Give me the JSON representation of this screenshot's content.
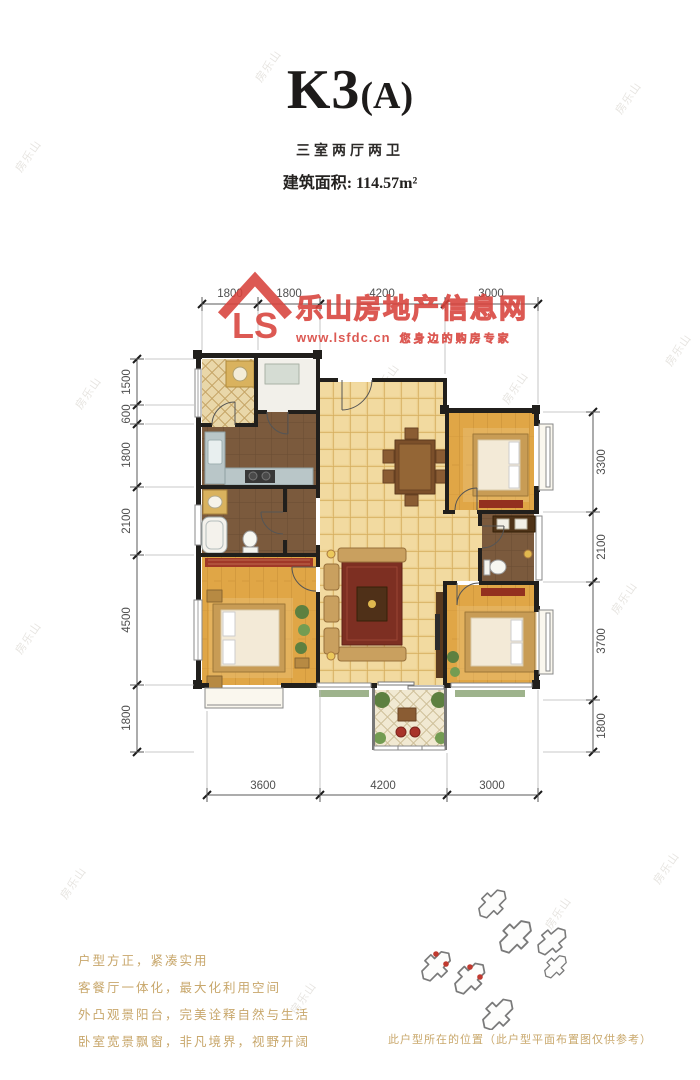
{
  "header": {
    "title_main": "K3",
    "title_paren": "(A)",
    "subtitle": "三室两厅两卫",
    "area": "建筑面积: 114.57m²"
  },
  "brand": {
    "monogram": "LS",
    "site_name": "乐山房地产信息网",
    "site_url": "www.lsfdc.cn",
    "tagline": "您身边的购房专家",
    "color": "#d8433c"
  },
  "watermark": {
    "text": "房乐山"
  },
  "dimensions": {
    "top": [
      "1800",
      "1800",
      "4200",
      "3000"
    ],
    "bottom": [
      "3600",
      "4200",
      "3000"
    ],
    "left": [
      "1500",
      "600",
      "1800",
      "2100",
      "4500",
      "1800"
    ],
    "right": [
      "3300",
      "2100",
      "3700",
      "1800"
    ]
  },
  "selling_points": [
    "户型方正，紧凑实用",
    "客餐厅一体化，最大化利用空间",
    "外凸观景阳台，完美诠释自然与生活",
    "卧室宽景飘窗，非凡境界，视野开阔"
  ],
  "site_plan": {
    "caption": "此户型所在的位置（此户型平面布置图仅供参考）"
  },
  "palette": {
    "tile_floor": "#eccf8e",
    "wood_floor": "#dfa446",
    "dark_floor": "#7b5a3d",
    "wall": "#211f1c",
    "accent_red": "#93301f",
    "brand_red": "#d8433c",
    "feature_text": "#c8a76b"
  }
}
